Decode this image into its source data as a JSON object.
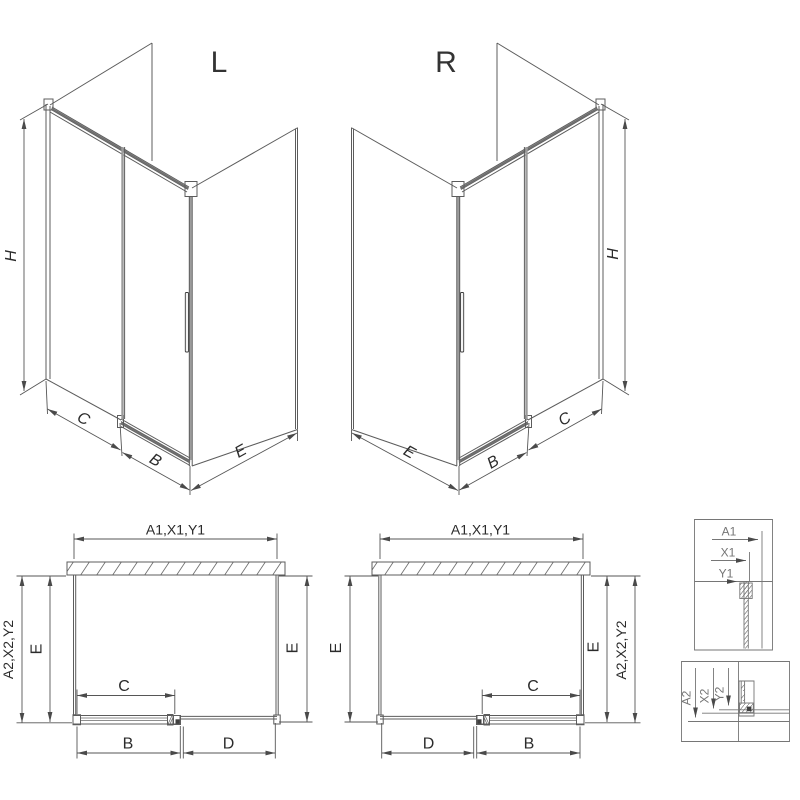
{
  "drawing": {
    "iso_left": {
      "variant_label": "L",
      "dim_height": "H",
      "dim_c": "C",
      "dim_b": "B",
      "dim_e": "E"
    },
    "iso_right": {
      "variant_label": "R",
      "dim_height": "H",
      "dim_c": "C",
      "dim_b": "B",
      "dim_e": "E"
    },
    "plan_left": {
      "dim_width_top": "A1,X1,Y1",
      "dim_depth_side": "A2,X2,Y2",
      "dim_e_left": "E",
      "dim_e_right": "E",
      "dim_c": "C",
      "dim_b": "B",
      "dim_d": "D"
    },
    "plan_right": {
      "dim_width_top": "A1,X1,Y1",
      "dim_depth_side": "A2,X2,Y2",
      "dim_e_left": "E",
      "dim_e_right": "E",
      "dim_c": "C",
      "dim_b": "B",
      "dim_d": "D"
    },
    "detail_width": {
      "labels": [
        "A1",
        "X1",
        "Y1"
      ]
    },
    "detail_height": {
      "labels": [
        "A2",
        "X2",
        "Y2"
      ]
    },
    "colors": {
      "line": "#5c5c5c",
      "dark": "#3f3f3f",
      "text": "#2e2e2e",
      "muted_text": "#757575",
      "door_edge": "#9c9c9c",
      "background": "#ffffff"
    }
  }
}
